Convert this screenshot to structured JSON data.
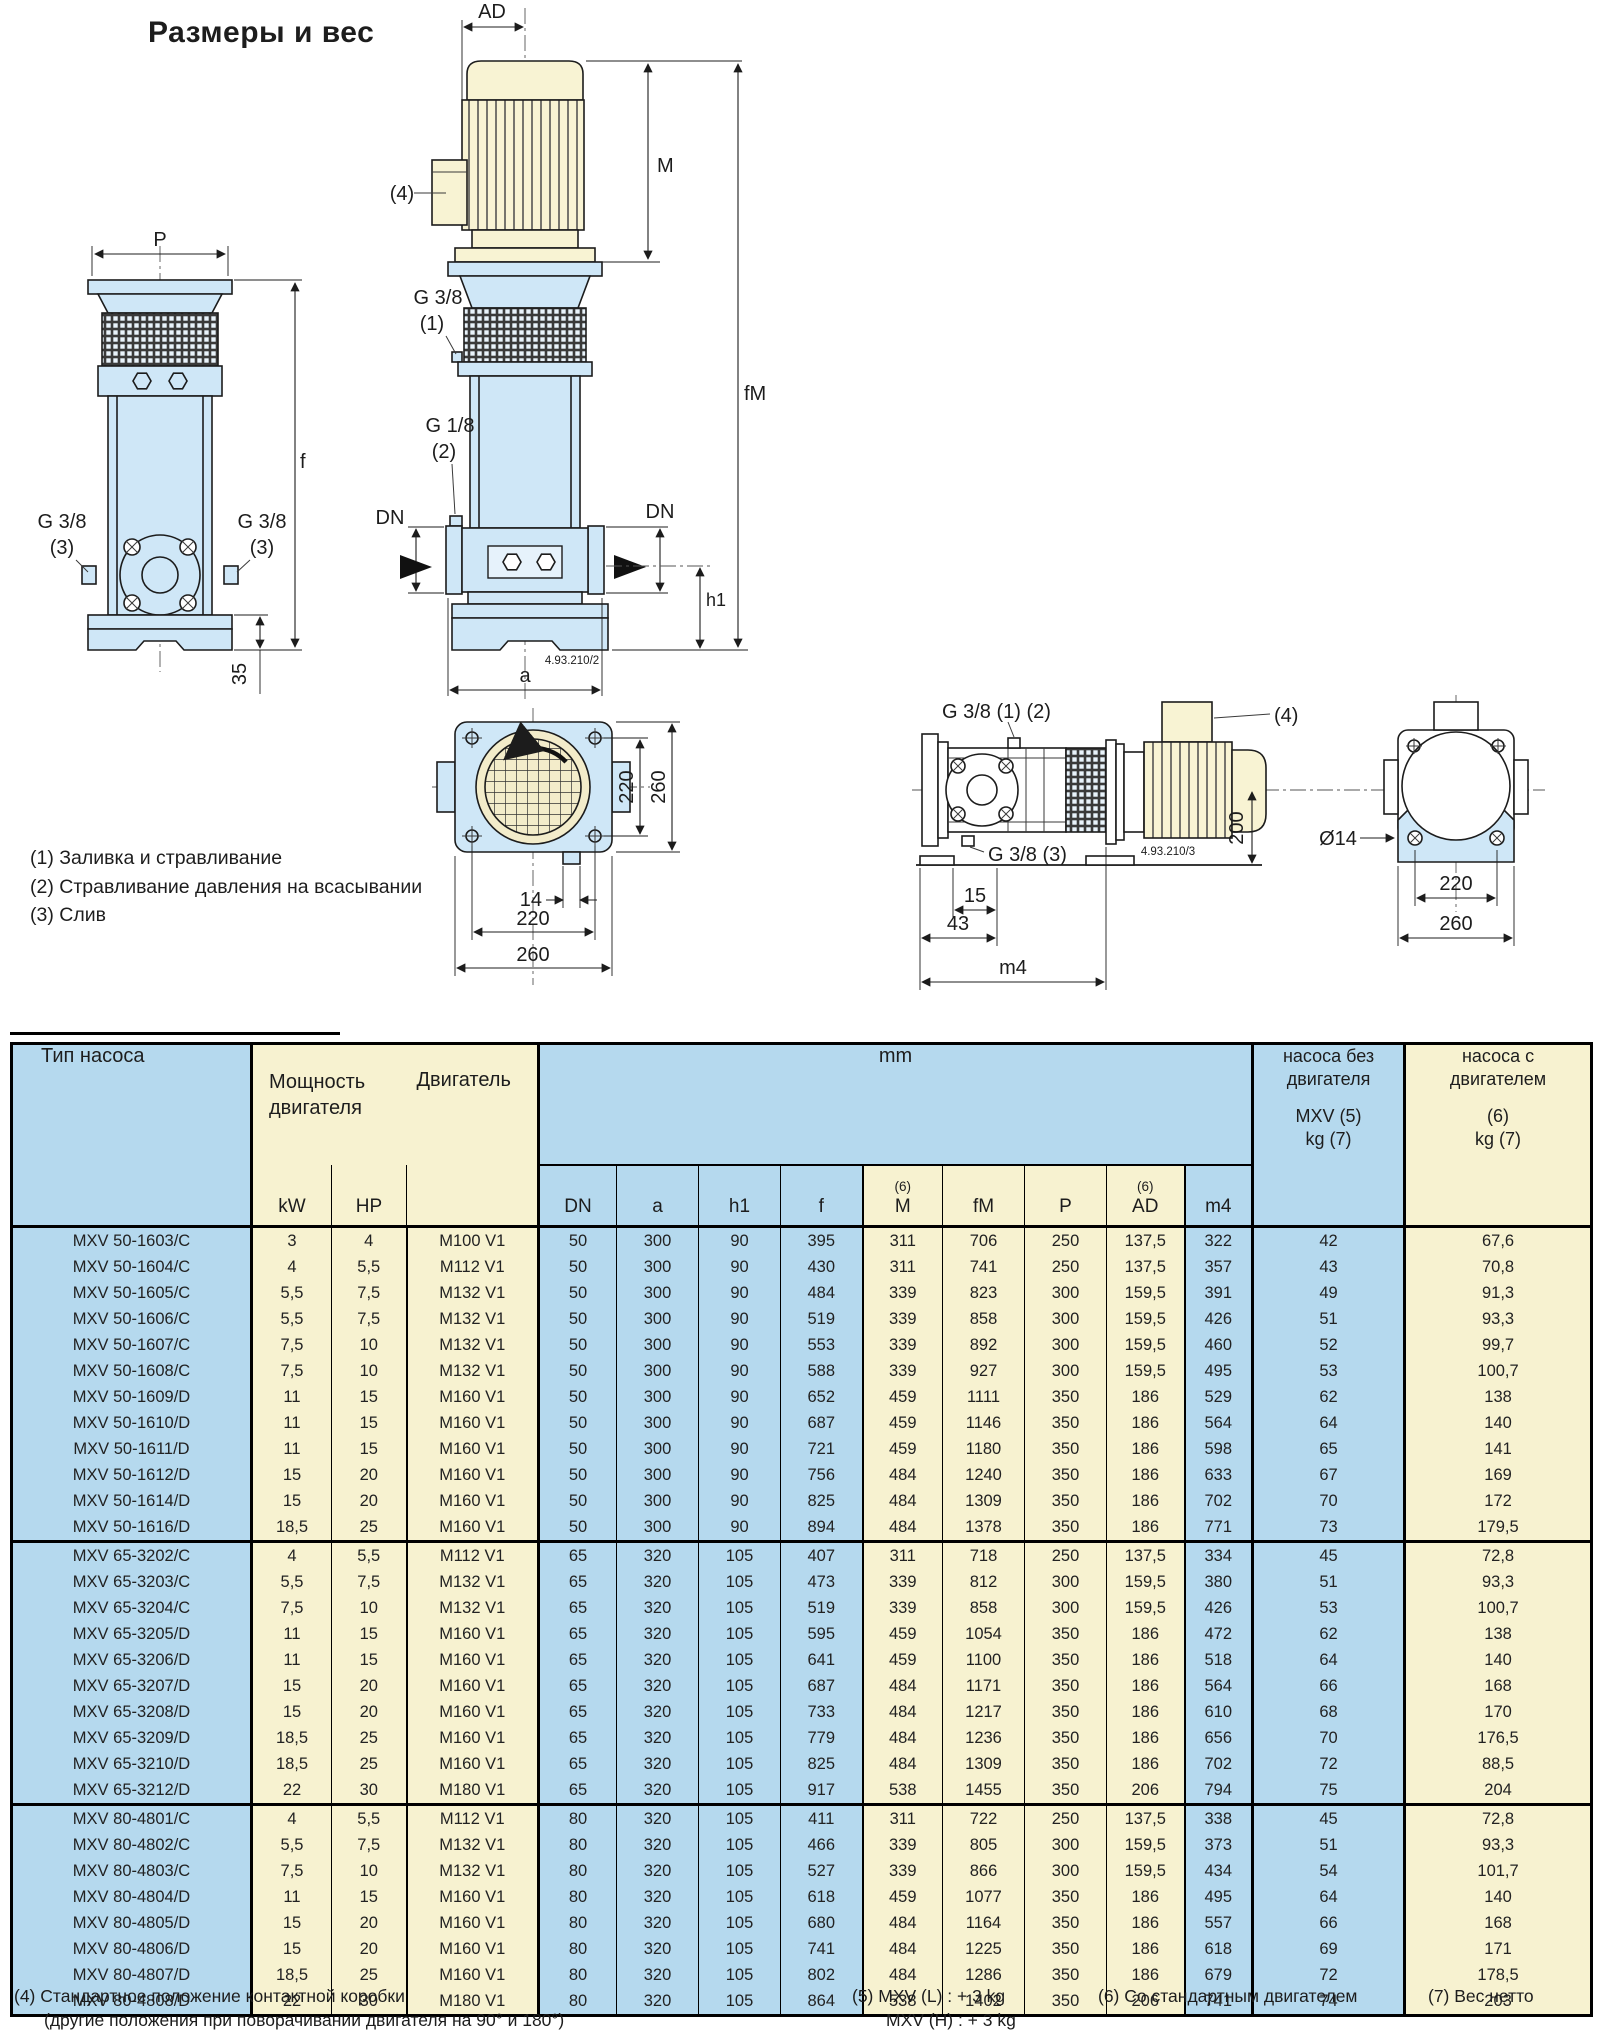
{
  "page": {
    "title": "Размеры и вес"
  },
  "drawing": {
    "labels": {
      "p": "P",
      "f": "f",
      "n35": "35",
      "g38": "G 3/8",
      "g18": "G 1/8",
      "n1": "(1)",
      "n2": "(2)",
      "n3": "(3)",
      "n4": "(4)",
      "ad": "AD",
      "m": "M",
      "fm": "fM",
      "dn": "DN",
      "h1": "h1",
      "a": "a",
      "dwg2": "4.93.210/2",
      "dwg3": "4.93.210/3",
      "g38_12": "G 3/8 (1) (2)",
      "g38_3": "G 3/8 (3)",
      "n15": "15",
      "n43": "43",
      "m4": "m4",
      "n200": "200",
      "d14": "Ø14",
      "n14": "14",
      "n220": "220",
      "n260": "260"
    },
    "notes": [
      "(1) Заливка и стравливание",
      "(2) Стравливание давления на всасывании",
      "(3) Слив"
    ]
  },
  "table": {
    "header": {
      "pump_type": "Тип насоса",
      "power_l1": "Мощность",
      "power_l2": "двигателя",
      "motor": "Двигатель",
      "kw": "kW",
      "hp": "HP",
      "mm": "mm",
      "sup6": "(6)",
      "dims": [
        "DN",
        "a",
        "h1",
        "f",
        "M",
        "fM",
        "P",
        "AD",
        "m4"
      ],
      "wo_l1": "насоса без",
      "wo_l2": "двигателя",
      "wo_l3": "MXV (5)",
      "wo_l4": "kg (7)",
      "wm_l1": "насоса с",
      "wm_l2": "двигателем",
      "wm_l3": "(6)",
      "wm_l4": "kg (7)"
    },
    "groups": [
      [
        [
          "MXV 50-1603/C",
          "3",
          "4",
          "M100 V1",
          "50",
          "300",
          "90",
          "395",
          "311",
          "706",
          "250",
          "137,5",
          "322",
          "42",
          "67,6"
        ],
        [
          "MXV 50-1604/C",
          "4",
          "5,5",
          "M112 V1",
          "50",
          "300",
          "90",
          "430",
          "311",
          "741",
          "250",
          "137,5",
          "357",
          "43",
          "70,8"
        ],
        [
          "MXV 50-1605/C",
          "5,5",
          "7,5",
          "M132 V1",
          "50",
          "300",
          "90",
          "484",
          "339",
          "823",
          "300",
          "159,5",
          "391",
          "49",
          "91,3"
        ],
        [
          "MXV 50-1606/C",
          "5,5",
          "7,5",
          "M132 V1",
          "50",
          "300",
          "90",
          "519",
          "339",
          "858",
          "300",
          "159,5",
          "426",
          "51",
          "93,3"
        ],
        [
          "MXV 50-1607/C",
          "7,5",
          "10",
          "M132 V1",
          "50",
          "300",
          "90",
          "553",
          "339",
          "892",
          "300",
          "159,5",
          "460",
          "52",
          "99,7"
        ],
        [
          "MXV 50-1608/C",
          "7,5",
          "10",
          "M132 V1",
          "50",
          "300",
          "90",
          "588",
          "339",
          "927",
          "300",
          "159,5",
          "495",
          "53",
          "100,7"
        ],
        [
          "MXV 50-1609/D",
          "11",
          "15",
          "M160 V1",
          "50",
          "300",
          "90",
          "652",
          "459",
          "1111",
          "350",
          "186",
          "529",
          "62",
          "138"
        ],
        [
          "MXV 50-1610/D",
          "11",
          "15",
          "M160 V1",
          "50",
          "300",
          "90",
          "687",
          "459",
          "1146",
          "350",
          "186",
          "564",
          "64",
          "140"
        ],
        [
          "MXV 50-1611/D",
          "11",
          "15",
          "M160 V1",
          "50",
          "300",
          "90",
          "721",
          "459",
          "1180",
          "350",
          "186",
          "598",
          "65",
          "141"
        ],
        [
          "MXV 50-1612/D",
          "15",
          "20",
          "M160 V1",
          "50",
          "300",
          "90",
          "756",
          "484",
          "1240",
          "350",
          "186",
          "633",
          "67",
          "169"
        ],
        [
          "MXV 50-1614/D",
          "15",
          "20",
          "M160 V1",
          "50",
          "300",
          "90",
          "825",
          "484",
          "1309",
          "350",
          "186",
          "702",
          "70",
          "172"
        ],
        [
          "MXV 50-1616/D",
          "18,5",
          "25",
          "M160 V1",
          "50",
          "300",
          "90",
          "894",
          "484",
          "1378",
          "350",
          "186",
          "771",
          "73",
          "179,5"
        ]
      ],
      [
        [
          "MXV 65-3202/C",
          "4",
          "5,5",
          "M112 V1",
          "65",
          "320",
          "105",
          "407",
          "311",
          "718",
          "250",
          "137,5",
          "334",
          "45",
          "72,8"
        ],
        [
          "MXV 65-3203/C",
          "5,5",
          "7,5",
          "M132 V1",
          "65",
          "320",
          "105",
          "473",
          "339",
          "812",
          "300",
          "159,5",
          "380",
          "51",
          "93,3"
        ],
        [
          "MXV 65-3204/C",
          "7,5",
          "10",
          "M132 V1",
          "65",
          "320",
          "105",
          "519",
          "339",
          "858",
          "300",
          "159,5",
          "426",
          "53",
          "100,7"
        ],
        [
          "MXV 65-3205/D",
          "11",
          "15",
          "M160 V1",
          "65",
          "320",
          "105",
          "595",
          "459",
          "1054",
          "350",
          "186",
          "472",
          "62",
          "138"
        ],
        [
          "MXV 65-3206/D",
          "11",
          "15",
          "M160 V1",
          "65",
          "320",
          "105",
          "641",
          "459",
          "1100",
          "350",
          "186",
          "518",
          "64",
          "140"
        ],
        [
          "MXV 65-3207/D",
          "15",
          "20",
          "M160 V1",
          "65",
          "320",
          "105",
          "687",
          "484",
          "1171",
          "350",
          "186",
          "564",
          "66",
          "168"
        ],
        [
          "MXV 65-3208/D",
          "15",
          "20",
          "M160 V1",
          "65",
          "320",
          "105",
          "733",
          "484",
          "1217",
          "350",
          "186",
          "610",
          "68",
          "170"
        ],
        [
          "MXV 65-3209/D",
          "18,5",
          "25",
          "M160 V1",
          "65",
          "320",
          "105",
          "779",
          "484",
          "1236",
          "350",
          "186",
          "656",
          "70",
          "176,5"
        ],
        [
          "MXV 65-3210/D",
          "18,5",
          "25",
          "M160 V1",
          "65",
          "320",
          "105",
          "825",
          "484",
          "1309",
          "350",
          "186",
          "702",
          "72",
          "88,5"
        ],
        [
          "MXV 65-3212/D",
          "22",
          "30",
          "M180 V1",
          "65",
          "320",
          "105",
          "917",
          "538",
          "1455",
          "350",
          "206",
          "794",
          "75",
          "204"
        ]
      ],
      [
        [
          "MXV 80-4801/C",
          "4",
          "5,5",
          "M112 V1",
          "80",
          "320",
          "105",
          "411",
          "311",
          "722",
          "250",
          "137,5",
          "338",
          "45",
          "72,8"
        ],
        [
          "MXV 80-4802/C",
          "5,5",
          "7,5",
          "M132 V1",
          "80",
          "320",
          "105",
          "466",
          "339",
          "805",
          "300",
          "159,5",
          "373",
          "51",
          "93,3"
        ],
        [
          "MXV 80-4803/C",
          "7,5",
          "10",
          "M132 V1",
          "80",
          "320",
          "105",
          "527",
          "339",
          "866",
          "300",
          "159,5",
          "434",
          "54",
          "101,7"
        ],
        [
          "MXV 80-4804/D",
          "11",
          "15",
          "M160 V1",
          "80",
          "320",
          "105",
          "618",
          "459",
          "1077",
          "350",
          "186",
          "495",
          "64",
          "140"
        ],
        [
          "MXV 80-4805/D",
          "15",
          "20",
          "M160 V1",
          "80",
          "320",
          "105",
          "680",
          "484",
          "1164",
          "350",
          "186",
          "557",
          "66",
          "168"
        ],
        [
          "MXV 80-4806/D",
          "15",
          "20",
          "M160 V1",
          "80",
          "320",
          "105",
          "741",
          "484",
          "1225",
          "350",
          "186",
          "618",
          "69",
          "171"
        ],
        [
          "MXV 80-4807/D",
          "18,5",
          "25",
          "M160 V1",
          "80",
          "320",
          "105",
          "802",
          "484",
          "1286",
          "350",
          "186",
          "679",
          "72",
          "178,5"
        ],
        [
          "MXV 80-4808/D",
          "22",
          "30",
          "M180 V1",
          "80",
          "320",
          "105",
          "864",
          "538",
          "1402",
          "350",
          "206",
          "741",
          "74",
          "203"
        ]
      ]
    ]
  },
  "footnotes": {
    "f4a": "(4) Стандартное положение контактной коробки",
    "f4b": "(другие положения при поворачивании двигателя на 90° и 180°)",
    "f5a": "(5) MXV (L) : + 3 kg",
    "f5b": "MXV (H) : + 3 kg",
    "f6": "(6) Со стандартным двигателем",
    "f7": "(7) Вес нетто"
  },
  "colors": {
    "table_blue": "#b5d9ee",
    "table_cream": "#f7f2d0",
    "drawing_blue": "#cfe7f7",
    "drawing_cream": "#f8f3d3"
  }
}
